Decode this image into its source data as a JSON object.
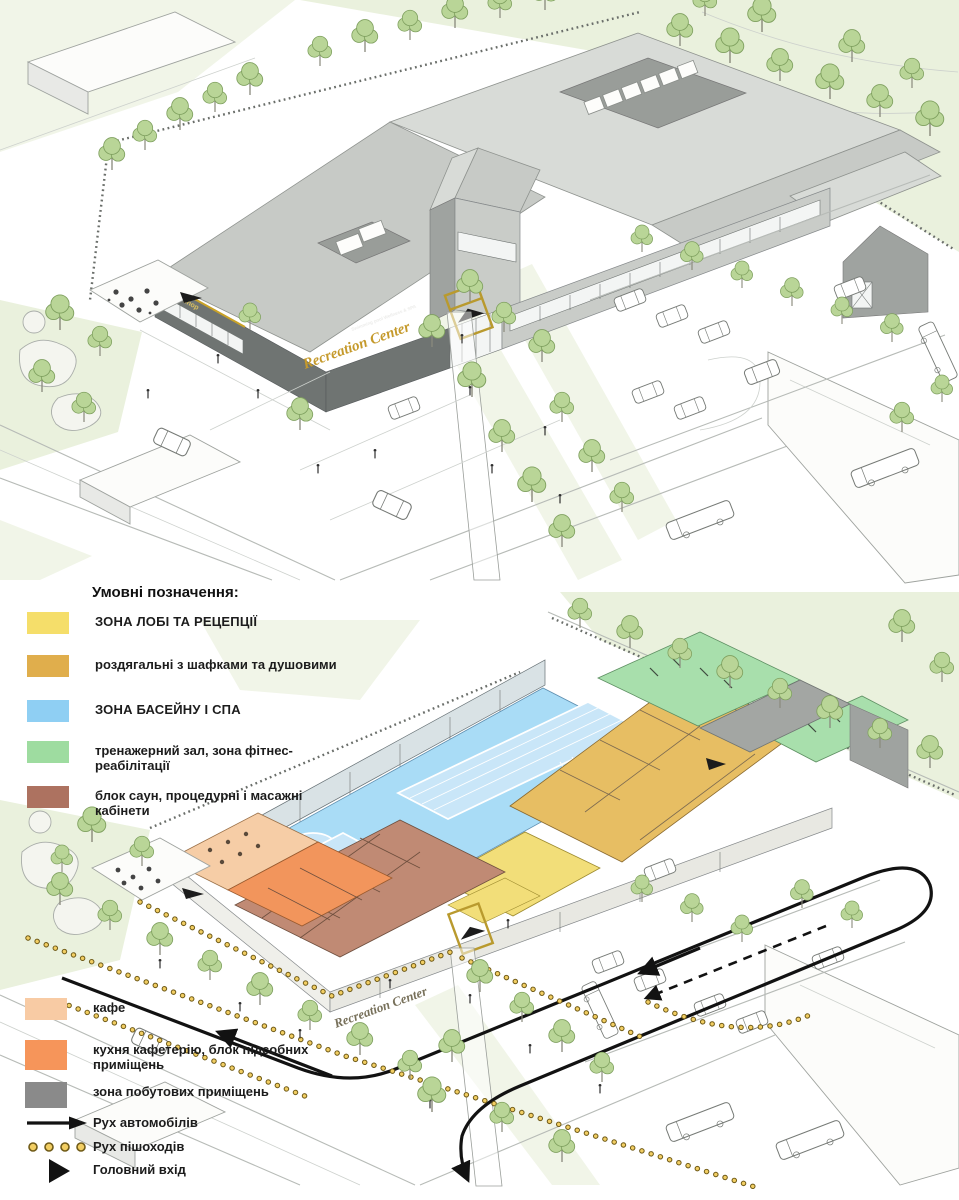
{
  "legend": {
    "title": "Умовні позначення:",
    "zones": [
      {
        "label": "ЗОНА ЛОБІ ТА РЕЦЕПЦІЇ",
        "color": "#F5DE6A"
      },
      {
        "label": "роздягальні з шафками та душовими",
        "color": "#E0AE4C"
      },
      {
        "label": "ЗОНА БАСЕЙНУ І СПА",
        "color": "#8FCFF3"
      },
      {
        "label": "тренажерний зал, зона фітнес-реабілітації",
        "color": "#9EDCA0"
      },
      {
        "label": "блок саун, процедурні і масажні кабінети",
        "color": "#AD7260"
      },
      {
        "label": "кафе",
        "color": "#F8CBA4"
      },
      {
        "label": "кухня кафетерію, блок підсобних приміщень",
        "color": "#F6955A"
      },
      {
        "label": "зона побутових приміщень",
        "color": "#8A8A8A"
      }
    ],
    "symbols": [
      {
        "label": "Рух автомобілів",
        "icon": "car-route-arrow-icon"
      },
      {
        "label": "Рух пішоходів",
        "icon": "pedestrian-dots-icon"
      },
      {
        "label": "Головний вхід",
        "icon": "main-entrance-triangle-icon"
      }
    ]
  },
  "building": {
    "sign_main": "Recreation Center",
    "sign_sub": "Swimming pool  Wellness & SPA",
    "sign_cafe": "coffee shop"
  },
  "colors": {
    "lobby": "#F5DE6A",
    "lockers": "#E0AE4C",
    "pool": "#8FCFF3",
    "gym": "#9EDCA0",
    "sauna": "#AD7260",
    "cafe": "#F8CBA4",
    "kitchen": "#F6955A",
    "utility": "#8A8A8A",
    "car_route": "#121212",
    "pedestrian_dot": "#F2CE63"
  }
}
